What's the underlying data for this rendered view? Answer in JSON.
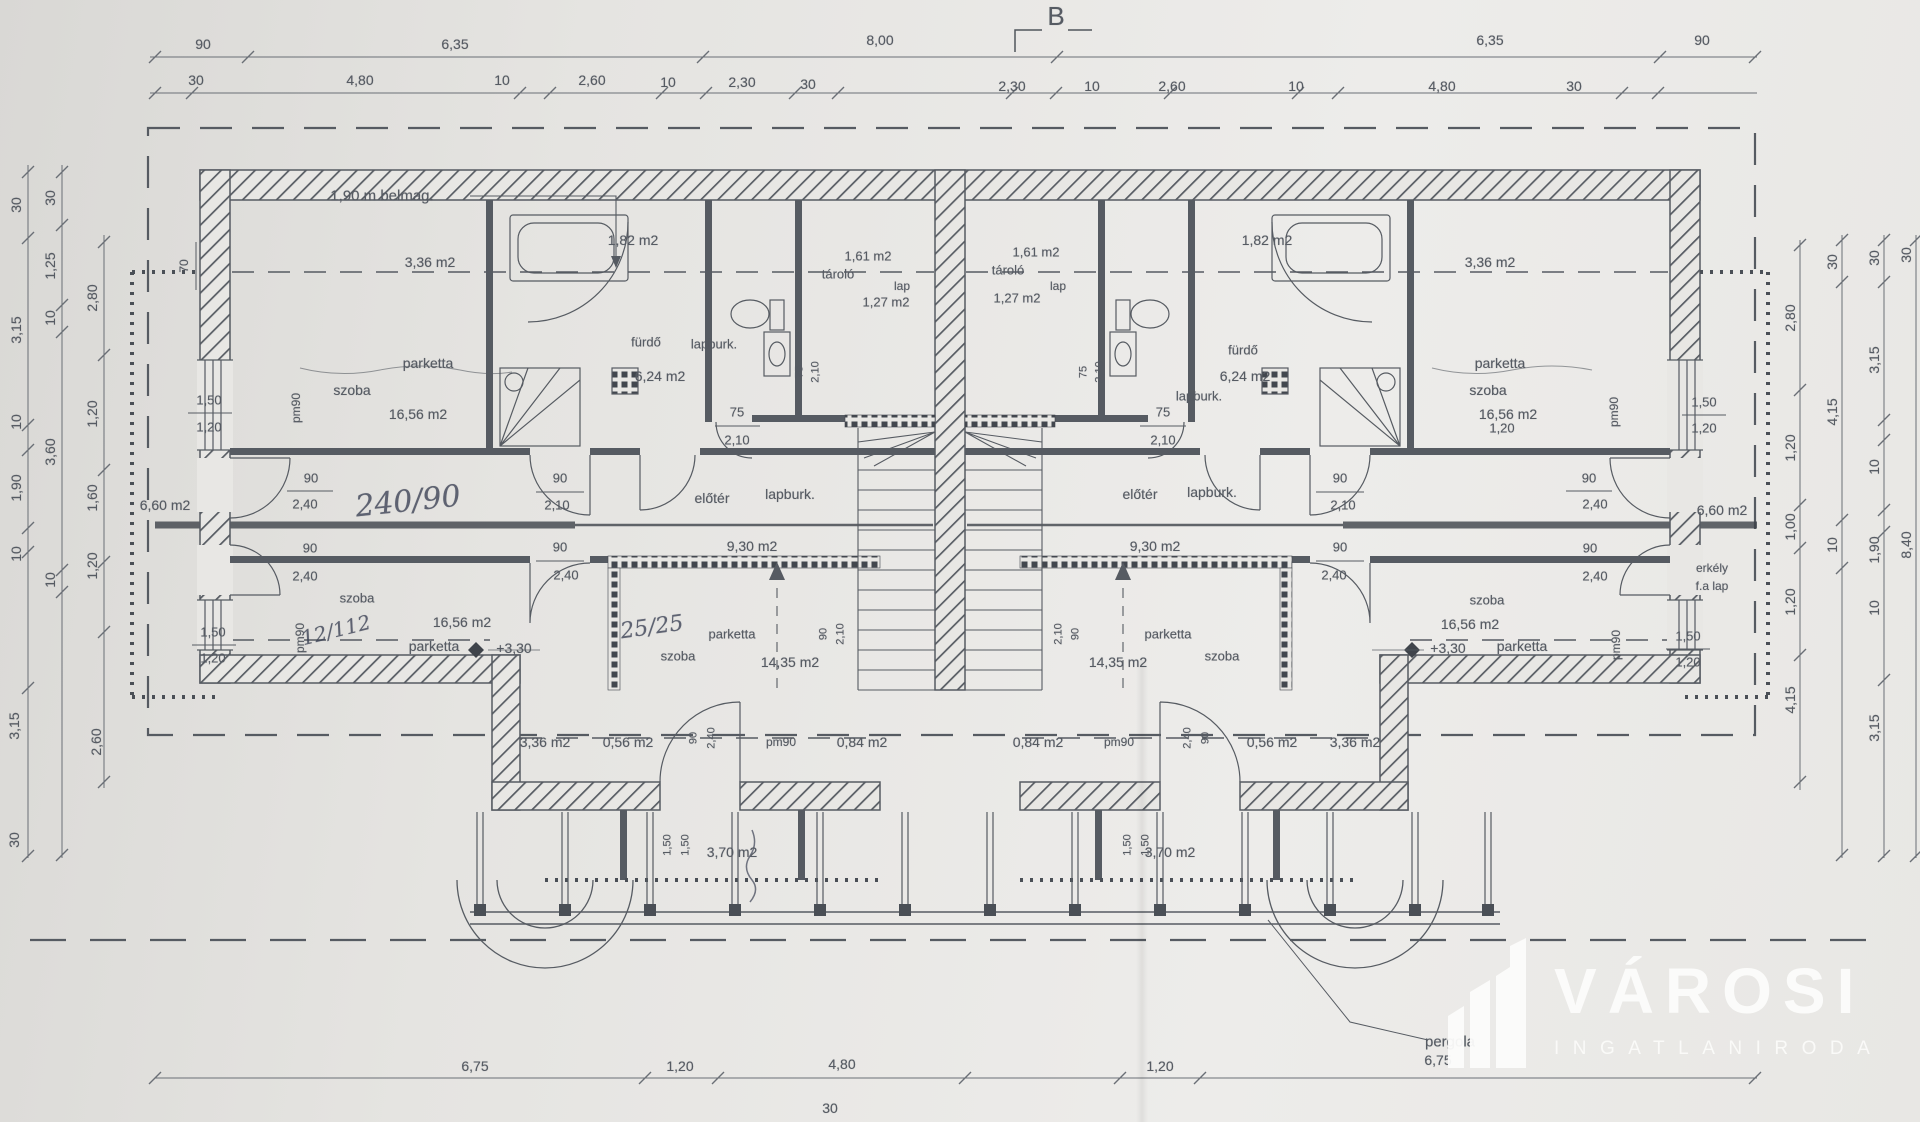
{
  "watermark": {
    "brand": "VÁROSI",
    "subtitle": "INGATLANIRODA"
  },
  "labels": [
    {
      "t": "90",
      "x": 203,
      "y": 44
    },
    {
      "t": "6,35",
      "x": 455,
      "y": 44
    },
    {
      "t": "8,00",
      "x": 880,
      "y": 40
    },
    {
      "t": "6,35",
      "x": 1490,
      "y": 40
    },
    {
      "t": "90",
      "x": 1702,
      "y": 40
    },
    {
      "t": "30",
      "x": 196,
      "y": 80
    },
    {
      "t": "4,80",
      "x": 360,
      "y": 80
    },
    {
      "t": "10",
      "x": 502,
      "y": 80
    },
    {
      "t": "2,60",
      "x": 592,
      "y": 80
    },
    {
      "t": "10",
      "x": 668,
      "y": 82
    },
    {
      "t": "2,30",
      "x": 742,
      "y": 82
    },
    {
      "t": "30",
      "x": 808,
      "y": 84
    },
    {
      "t": "2,30",
      "x": 1012,
      "y": 86
    },
    {
      "t": "10",
      "x": 1092,
      "y": 86
    },
    {
      "t": "2,60",
      "x": 1172,
      "y": 86
    },
    {
      "t": "10",
      "x": 1296,
      "y": 86
    },
    {
      "t": "4,80",
      "x": 1442,
      "y": 86
    },
    {
      "t": "30",
      "x": 1574,
      "y": 86
    },
    {
      "t": "B",
      "x": 1056,
      "y": 16,
      "s": 26
    },
    {
      "t": "30",
      "x": 16,
      "y": 205,
      "r": -90
    },
    {
      "t": "3,15",
      "x": 16,
      "y": 330,
      "r": -90
    },
    {
      "t": "10",
      "x": 16,
      "y": 422,
      "r": -90
    },
    {
      "t": "1,90",
      "x": 16,
      "y": 488,
      "r": -90
    },
    {
      "t": "10",
      "x": 16,
      "y": 554,
      "r": -90
    },
    {
      "t": "3,15",
      "x": 14,
      "y": 726,
      "r": -90
    },
    {
      "t": "30",
      "x": 14,
      "y": 840,
      "r": -90
    },
    {
      "t": "30",
      "x": 50,
      "y": 198,
      "r": -90
    },
    {
      "t": "1,25",
      "x": 50,
      "y": 266,
      "r": -90
    },
    {
      "t": "10",
      "x": 50,
      "y": 318,
      "r": -90
    },
    {
      "t": "3,60",
      "x": 50,
      "y": 452,
      "r": -90
    },
    {
      "t": "10",
      "x": 50,
      "y": 580,
      "r": -90
    },
    {
      "t": "2,80",
      "x": 92,
      "y": 298,
      "r": -90
    },
    {
      "t": "1,20",
      "x": 92,
      "y": 414,
      "r": -90
    },
    {
      "t": "1,60",
      "x": 92,
      "y": 498,
      "r": -90
    },
    {
      "t": "1,20",
      "x": 92,
      "y": 566,
      "r": -90
    },
    {
      "t": "2,60",
      "x": 96,
      "y": 742,
      "r": -90
    },
    {
      "t": "70",
      "x": 184,
      "y": 266,
      "r": -90,
      "s": 12
    },
    {
      "t": "2,80",
      "x": 1790,
      "y": 318,
      "r": -90
    },
    {
      "t": "1,20",
      "x": 1790,
      "y": 448,
      "r": -90
    },
    {
      "t": "1,00",
      "x": 1790,
      "y": 527,
      "r": -90
    },
    {
      "t": "1,20",
      "x": 1790,
      "y": 602,
      "r": -90
    },
    {
      "t": "4,15",
      "x": 1790,
      "y": 700,
      "r": -90
    },
    {
      "t": "30",
      "x": 1832,
      "y": 262,
      "r": -90
    },
    {
      "t": "4,15",
      "x": 1832,
      "y": 412,
      "r": -90
    },
    {
      "t": "10",
      "x": 1832,
      "y": 545,
      "r": -90
    },
    {
      "t": "30",
      "x": 1874,
      "y": 258,
      "r": -90
    },
    {
      "t": "3,15",
      "x": 1874,
      "y": 360,
      "r": -90
    },
    {
      "t": "10",
      "x": 1874,
      "y": 467,
      "r": -90
    },
    {
      "t": "1,90",
      "x": 1874,
      "y": 550,
      "r": -90
    },
    {
      "t": "10",
      "x": 1874,
      "y": 608,
      "r": -90
    },
    {
      "t": "3,15",
      "x": 1874,
      "y": 728,
      "r": -90
    },
    {
      "t": "30",
      "x": 1906,
      "y": 255,
      "r": -90
    },
    {
      "t": "8,40",
      "x": 1906,
      "y": 545,
      "r": -90
    },
    {
      "t": "6,75",
      "x": 475,
      "y": 1066
    },
    {
      "t": "1,20",
      "x": 680,
      "y": 1066
    },
    {
      "t": "4,80",
      "x": 842,
      "y": 1064
    },
    {
      "t": "1,20",
      "x": 1160,
      "y": 1066
    },
    {
      "t": "6,75",
      "x": 1438,
      "y": 1060
    },
    {
      "t": "30",
      "x": 830,
      "y": 1108
    },
    {
      "t": "pergola",
      "x": 1450,
      "y": 1042,
      "s": 15
    },
    {
      "t": "1,90 m belmag.",
      "x": 382,
      "y": 196,
      "s": 15
    },
    {
      "t": "3,36 m2",
      "x": 430,
      "y": 262
    },
    {
      "t": "3,36 m2",
      "x": 1490,
      "y": 262
    },
    {
      "t": "1,82 m2",
      "x": 633,
      "y": 240
    },
    {
      "t": "1,82 m2",
      "x": 1267,
      "y": 240
    },
    {
      "t": "fürdő",
      "x": 646,
      "y": 342,
      "s": 13
    },
    {
      "t": "lapburk.",
      "x": 714,
      "y": 344,
      "s": 13
    },
    {
      "t": "6,24 m2",
      "x": 660,
      "y": 376
    },
    {
      "t": "fürdő",
      "x": 1243,
      "y": 350,
      "s": 13
    },
    {
      "t": "6,24 m2",
      "x": 1245,
      "y": 376
    },
    {
      "t": "lapburk.",
      "x": 1199,
      "y": 396,
      "s": 13
    },
    {
      "t": "1,61 m2",
      "x": 868,
      "y": 256,
      "s": 13
    },
    {
      "t": "tároló",
      "x": 838,
      "y": 274,
      "s": 13
    },
    {
      "t": "lap",
      "x": 902,
      "y": 286,
      "s": 12
    },
    {
      "t": "1,27 m2",
      "x": 886,
      "y": 302,
      "s": 13
    },
    {
      "t": "1,61 m2",
      "x": 1036,
      "y": 252,
      "s": 13
    },
    {
      "t": "tároló",
      "x": 1008,
      "y": 270,
      "s": 13
    },
    {
      "t": "lap",
      "x": 1058,
      "y": 286,
      "s": 12
    },
    {
      "t": "1,27 m2",
      "x": 1017,
      "y": 298,
      "s": 13
    },
    {
      "t": "parketta",
      "x": 428,
      "y": 363
    },
    {
      "t": "szoba",
      "x": 352,
      "y": 390
    },
    {
      "t": "16,56 m2",
      "x": 418,
      "y": 414
    },
    {
      "t": "parketta",
      "x": 1500,
      "y": 363
    },
    {
      "t": "szoba",
      "x": 1488,
      "y": 390
    },
    {
      "t": "16,56 m2",
      "x": 1508,
      "y": 414
    },
    {
      "t": "pm90",
      "x": 296,
      "y": 408,
      "r": -90,
      "s": 12
    },
    {
      "t": "pm90",
      "x": 1614,
      "y": 412,
      "r": -90,
      "s": 12
    },
    {
      "t": "pm90",
      "x": 300,
      "y": 638,
      "r": -90,
      "s": 12
    },
    {
      "t": "pm90",
      "x": 1616,
      "y": 645,
      "r": -90,
      "s": 12
    },
    {
      "t": "1,50",
      "x": 209,
      "y": 400,
      "s": 13
    },
    {
      "t": "1,20",
      "x": 209,
      "y": 427,
      "s": 13
    },
    {
      "t": "1,50",
      "x": 213,
      "y": 632,
      "s": 13
    },
    {
      "t": "1,20",
      "x": 213,
      "y": 658,
      "s": 13
    },
    {
      "t": "1,50",
      "x": 1704,
      "y": 402,
      "s": 13
    },
    {
      "t": "1,20",
      "x": 1704,
      "y": 428,
      "s": 13
    },
    {
      "t": "1,50",
      "x": 1688,
      "y": 636,
      "s": 13
    },
    {
      "t": "1,20",
      "x": 1688,
      "y": 662,
      "s": 13
    },
    {
      "t": "1,20",
      "x": 1502,
      "y": 428,
      "s": 13
    },
    {
      "t": "6,60 m2",
      "x": 165,
      "y": 505
    },
    {
      "t": "6,60 m2",
      "x": 1722,
      "y": 510
    },
    {
      "t": "erkély",
      "x": 1712,
      "y": 568,
      "s": 12
    },
    {
      "t": "f.a lap",
      "x": 1712,
      "y": 586,
      "s": 12
    },
    {
      "t": "90",
      "x": 311,
      "y": 478,
      "s": 13
    },
    {
      "t": "2,40",
      "x": 305,
      "y": 504,
      "s": 13
    },
    {
      "t": "90",
      "x": 310,
      "y": 548,
      "s": 13
    },
    {
      "t": "2,40",
      "x": 305,
      "y": 576,
      "s": 13
    },
    {
      "t": "90",
      "x": 1589,
      "y": 478,
      "s": 13
    },
    {
      "t": "2,40",
      "x": 1595,
      "y": 504,
      "s": 13
    },
    {
      "t": "90",
      "x": 1590,
      "y": 548,
      "s": 13
    },
    {
      "t": "2,40",
      "x": 1595,
      "y": 576,
      "s": 13
    },
    {
      "t": "90",
      "x": 560,
      "y": 478,
      "s": 13
    },
    {
      "t": "2,10",
      "x": 557,
      "y": 505,
      "s": 13
    },
    {
      "t": "90",
      "x": 560,
      "y": 547,
      "s": 13
    },
    {
      "t": "2,40",
      "x": 566,
      "y": 575,
      "s": 13
    },
    {
      "t": "90",
      "x": 1340,
      "y": 478,
      "s": 13
    },
    {
      "t": "2,10",
      "x": 1343,
      "y": 505,
      "s": 13
    },
    {
      "t": "90",
      "x": 1340,
      "y": 547,
      "s": 13
    },
    {
      "t": "2,40",
      "x": 1334,
      "y": 575,
      "s": 13
    },
    {
      "t": "75",
      "x": 737,
      "y": 412,
      "s": 13
    },
    {
      "t": "2,10",
      "x": 737,
      "y": 440,
      "s": 13
    },
    {
      "t": "75",
      "x": 1163,
      "y": 412,
      "s": 13
    },
    {
      "t": "2,10",
      "x": 1163,
      "y": 440,
      "s": 13
    },
    {
      "t": "75",
      "x": 800,
      "y": 372,
      "r": -90,
      "s": 11
    },
    {
      "t": "2,10",
      "x": 816,
      "y": 372,
      "r": -90,
      "s": 11
    },
    {
      "t": "75",
      "x": 1084,
      "y": 372,
      "r": -90,
      "s": 11
    },
    {
      "t": "2,10",
      "x": 1100,
      "y": 372,
      "r": -90,
      "s": 11
    },
    {
      "t": "előtér",
      "x": 712,
      "y": 498
    },
    {
      "t": "lapburk.",
      "x": 790,
      "y": 494
    },
    {
      "t": "9,30 m2",
      "x": 752,
      "y": 546
    },
    {
      "t": "előtér",
      "x": 1140,
      "y": 494
    },
    {
      "t": "lapburk.",
      "x": 1212,
      "y": 492
    },
    {
      "t": "9,30 m2",
      "x": 1155,
      "y": 546
    },
    {
      "t": "parketta",
      "x": 732,
      "y": 634,
      "s": 13
    },
    {
      "t": "szoba",
      "x": 678,
      "y": 656,
      "s": 13
    },
    {
      "t": "14,35 m2",
      "x": 790,
      "y": 662
    },
    {
      "t": "parketta",
      "x": 1168,
      "y": 634,
      "s": 13
    },
    {
      "t": "szoba",
      "x": 1222,
      "y": 656,
      "s": 13
    },
    {
      "t": "14,35 m2",
      "x": 1118,
      "y": 662
    },
    {
      "t": "90",
      "x": 824,
      "y": 634,
      "r": -90,
      "s": 11
    },
    {
      "t": "2,10",
      "x": 841,
      "y": 634,
      "r": -90,
      "s": 11
    },
    {
      "t": "90",
      "x": 1076,
      "y": 634,
      "r": -90,
      "s": 11
    },
    {
      "t": "2,10",
      "x": 1059,
      "y": 634,
      "r": -90,
      "s": 11
    },
    {
      "t": "szoba",
      "x": 357,
      "y": 598,
      "s": 13
    },
    {
      "t": "16,56 m2",
      "x": 462,
      "y": 622
    },
    {
      "t": "parketta",
      "x": 434,
      "y": 646
    },
    {
      "t": "+3,30",
      "x": 514,
      "y": 648
    },
    {
      "t": "szoba",
      "x": 1487,
      "y": 600,
      "s": 13
    },
    {
      "t": "16,56 m2",
      "x": 1470,
      "y": 624
    },
    {
      "t": "parketta",
      "x": 1522,
      "y": 646
    },
    {
      "t": "+3,30",
      "x": 1448,
      "y": 648
    },
    {
      "t": "3,36 m2",
      "x": 545,
      "y": 742
    },
    {
      "t": "0,56 m2",
      "x": 628,
      "y": 742
    },
    {
      "t": "90",
      "x": 694,
      "y": 738,
      "r": -90,
      "s": 11
    },
    {
      "t": "2,40",
      "x": 712,
      "y": 738,
      "r": -90,
      "s": 11
    },
    {
      "t": "pm90",
      "x": 781,
      "y": 742,
      "s": 12
    },
    {
      "t": "0,84 m2",
      "x": 862,
      "y": 742
    },
    {
      "t": "0,84 m2",
      "x": 1038,
      "y": 742
    },
    {
      "t": "pm90",
      "x": 1119,
      "y": 742,
      "s": 12
    },
    {
      "t": "2,40",
      "x": 1188,
      "y": 738,
      "r": -90,
      "s": 11
    },
    {
      "t": "90",
      "x": 1206,
      "y": 738,
      "r": -90,
      "s": 11
    },
    {
      "t": "0,56 m2",
      "x": 1272,
      "y": 742
    },
    {
      "t": "3,36 m2",
      "x": 1355,
      "y": 742
    },
    {
      "t": "3,70 m2",
      "x": 732,
      "y": 852
    },
    {
      "t": "3,70 m2",
      "x": 1170,
      "y": 852
    },
    {
      "t": "1,50",
      "x": 668,
      "y": 845,
      "r": -90,
      "s": 11
    },
    {
      "t": "1,50",
      "x": 686,
      "y": 845,
      "r": -90,
      "s": 11
    },
    {
      "t": "1,50",
      "x": 1128,
      "y": 845,
      "r": -90,
      "s": 11
    },
    {
      "t": "1,50",
      "x": 1146,
      "y": 845,
      "r": -90,
      "s": 11
    },
    {
      "t": "240/90",
      "x": 408,
      "y": 502,
      "r": -6,
      "s": 30,
      "c": "hw"
    },
    {
      "t": "12/112",
      "x": 336,
      "y": 630,
      "r": -14,
      "s": 20,
      "c": "hw"
    },
    {
      "t": "25/25",
      "x": 652,
      "y": 628,
      "r": -8,
      "s": 22,
      "c": "hw"
    }
  ]
}
